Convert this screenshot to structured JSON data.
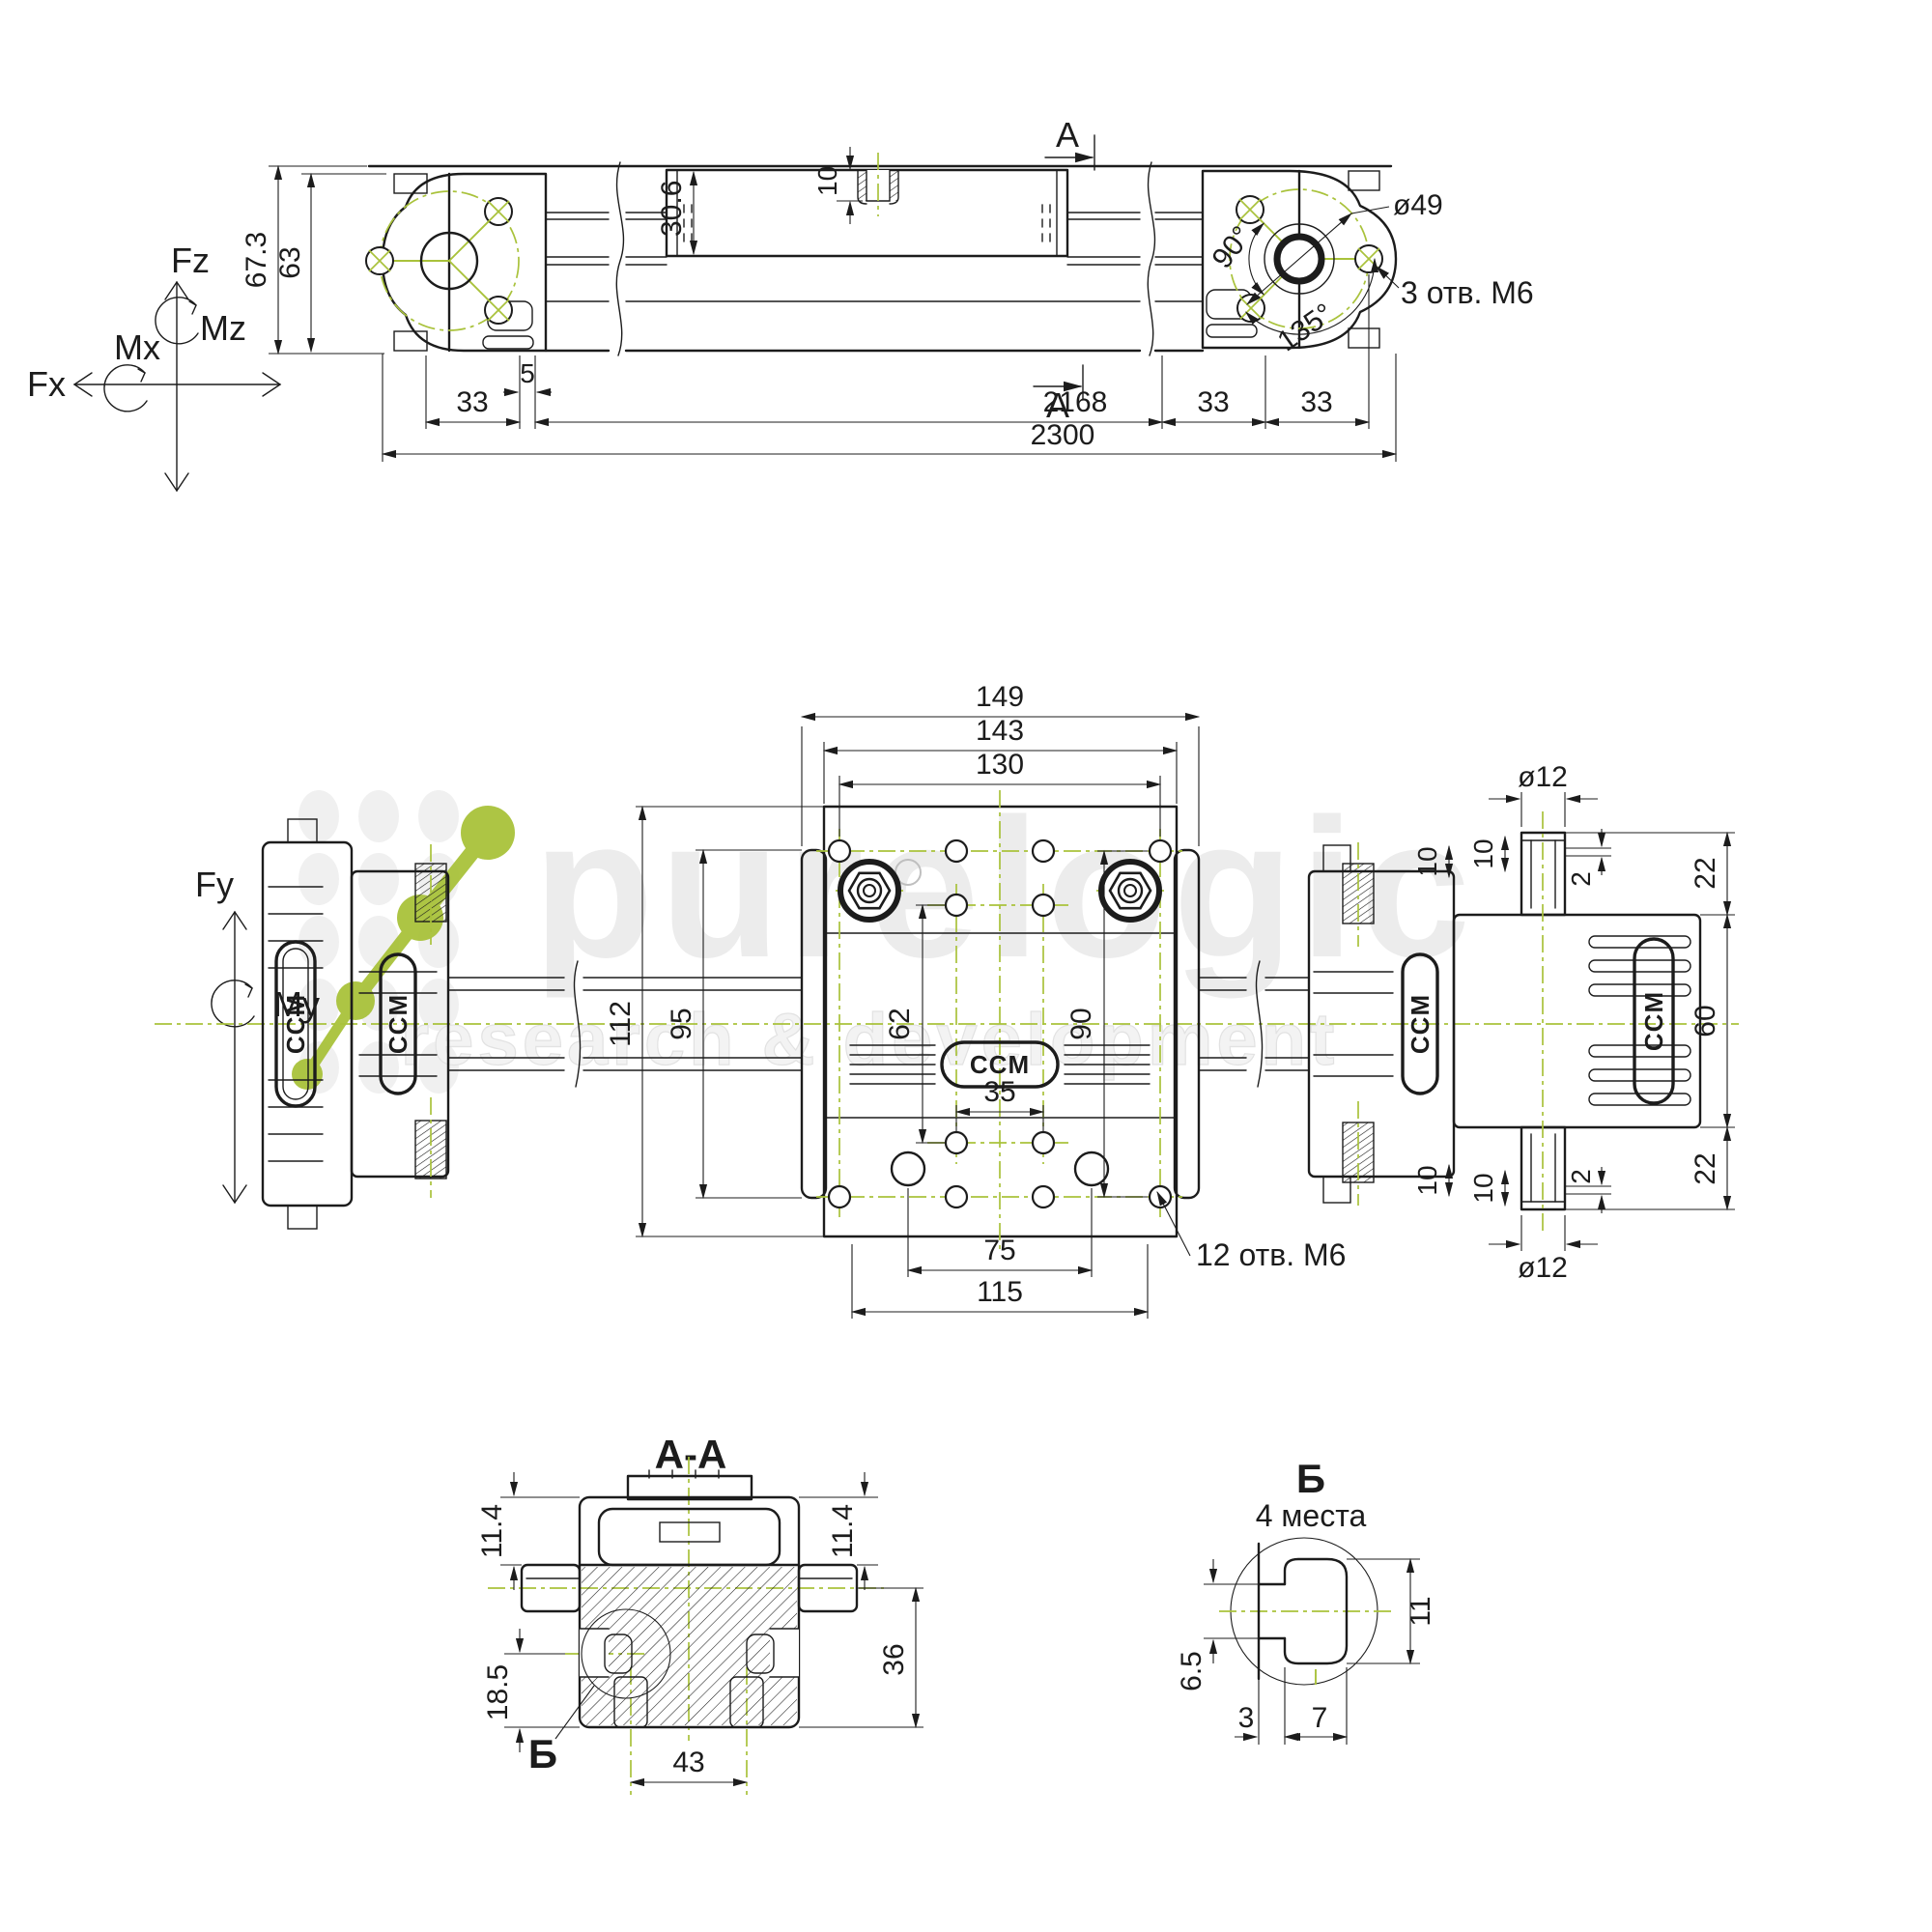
{
  "watermark": {
    "brand": "purelogic",
    "tagline": "research & development"
  },
  "force_axes": {
    "fz": "Fz",
    "mz": "Mz",
    "mx": "Mx",
    "fx": "Fx",
    "fy": "Fy",
    "my": "My"
  },
  "top_view": {
    "section_label": "A",
    "dims": {
      "overall_height": "67.3",
      "body_height": "63",
      "carriage_height": "30.6",
      "thread_depth": "10",
      "offset_33": "33",
      "offset_5": "5",
      "stroke": "2168",
      "total": "2300",
      "bolt_circle_dia": "ø49",
      "angle_a": "90°",
      "angle_b": "135°"
    },
    "notes": {
      "end_holes": "3 отв. М6"
    }
  },
  "middle_view": {
    "logo": "CCM",
    "dims": {
      "w149": "149",
      "w143": "143",
      "w130": "130",
      "h112": "112",
      "h95": "95",
      "h62": "62",
      "h90": "90",
      "w35": "35",
      "w75": "75",
      "w115": "115",
      "port_dia": "ø12",
      "p10": "10",
      "p2": "2",
      "p22": "22",
      "h60": "60"
    },
    "notes": {
      "plate_holes": "12 отв. М6"
    }
  },
  "section_aa": {
    "title": "A-A",
    "detail_mark": "Б",
    "dims": {
      "d114": "11.4",
      "d185": "18.5",
      "d36": "36",
      "d43": "43"
    }
  },
  "detail_b": {
    "title": "Б",
    "subtitle": "4 места",
    "dims": {
      "d65": "6.5",
      "d11": "11",
      "d3": "3",
      "d7": "7"
    }
  }
}
